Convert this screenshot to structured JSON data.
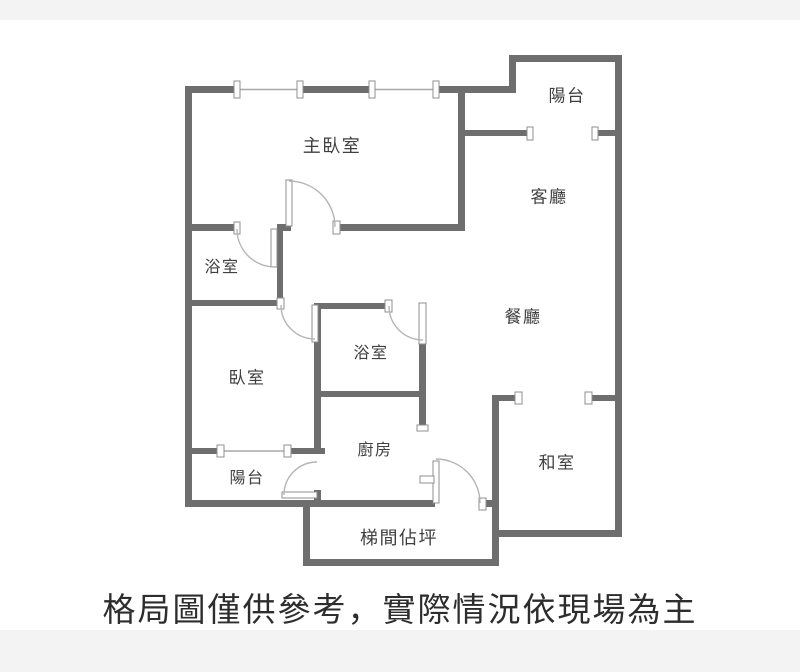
{
  "meta": {
    "caption": "格局圖僅供參考，實際情況依現場為主"
  },
  "rooms": [
    {
      "id": "master-bedroom",
      "label": "主臥室",
      "x": 332,
      "y": 147,
      "size": 18
    },
    {
      "id": "balcony-north",
      "label": "陽台",
      "x": 567,
      "y": 97,
      "size": 17
    },
    {
      "id": "living-room",
      "label": "客廳",
      "x": 549,
      "y": 198,
      "size": 17
    },
    {
      "id": "bathroom-master",
      "label": "浴室",
      "x": 222,
      "y": 267,
      "size": 16
    },
    {
      "id": "dining-room",
      "label": "餐廳",
      "x": 523,
      "y": 318,
      "size": 17
    },
    {
      "id": "bathroom",
      "label": "浴室",
      "x": 371,
      "y": 353,
      "size": 16
    },
    {
      "id": "bedroom",
      "label": "臥室",
      "x": 247,
      "y": 379,
      "size": 17
    },
    {
      "id": "kitchen",
      "label": "廚房",
      "x": 375,
      "y": 450,
      "size": 16
    },
    {
      "id": "tatami-room",
      "label": "和室",
      "x": 557,
      "y": 464,
      "size": 17
    },
    {
      "id": "balcony-south",
      "label": "陽台",
      "x": 247,
      "y": 478,
      "size": 16
    },
    {
      "id": "stairwell",
      "label": "梯間佔坪",
      "x": 399,
      "y": 539,
      "size": 18
    }
  ],
  "colors": {
    "wall": "#6e6e6e",
    "door": "#8f8f8f",
    "arc": "#b5b5b5",
    "win": "#a8a8a8",
    "label": "#404040",
    "caption": "#2d2d2d",
    "band": "#f3f3f3"
  }
}
